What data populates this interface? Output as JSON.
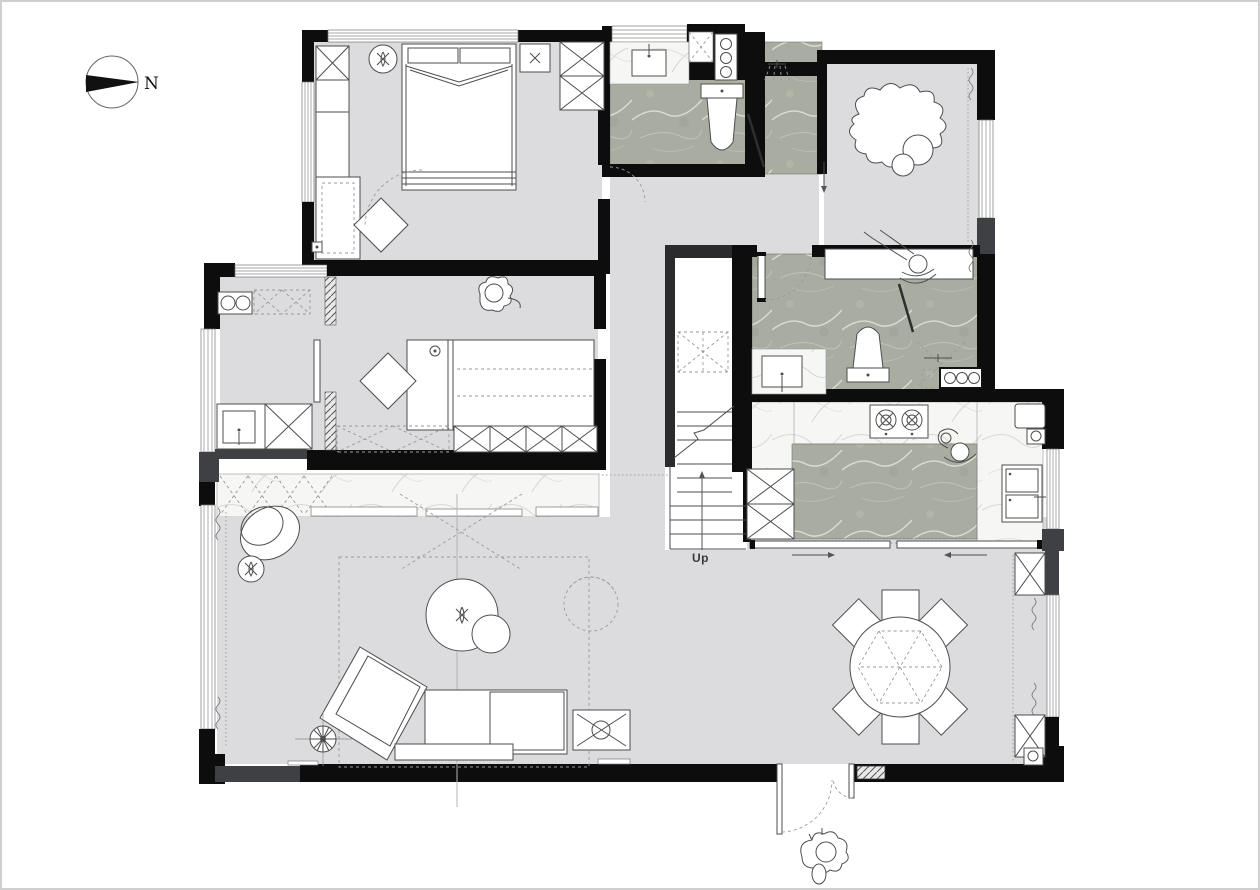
{
  "page": {
    "background": "#ffffff",
    "frame_color": "#cfcfcf",
    "type": "residential-floor-plan"
  },
  "labels": {
    "compass_north": "N",
    "stairs_up": "Up"
  },
  "colors": {
    "wall": "#0d0d0d",
    "wall_secondary": "#3e4043",
    "floor": "#dcdcde",
    "stone_floor": "#a9ada1",
    "marble_counter": "#f5f5f4",
    "outline": "#4d4d4d",
    "dashed": "#9a9a9a"
  },
  "rooms": [
    {
      "name": "master-bedroom",
      "furniture": [
        "double-bed",
        "wardrobe",
        "bookshelf-desk",
        "bedside-lamp",
        "nightstand",
        "ottoman"
      ]
    },
    {
      "name": "master-bathroom",
      "furniture": [
        "vanity-sink",
        "toilet",
        "shower-head",
        "washer-column"
      ]
    },
    {
      "name": "study",
      "furniture": [
        "desk",
        "person-working",
        "bean-bag",
        "cushions"
      ]
    },
    {
      "name": "second-bathroom",
      "furniture": [
        "vanity-sink",
        "toilet",
        "shower",
        "knob-cabinet"
      ]
    },
    {
      "name": "kitchen",
      "furniture": [
        "island",
        "cooktop-2-burner",
        "sink",
        "refrigerator",
        "person-cooking",
        "sliding-door"
      ]
    },
    {
      "name": "second-bedroom",
      "furniture": [
        "bed",
        "wardrobe",
        "ottoman",
        "cat",
        "bedside-lamp"
      ]
    },
    {
      "name": "kitchenette",
      "furniture": [
        "cooktop-2-burner",
        "sink",
        "cabinet"
      ]
    },
    {
      "name": "living-room",
      "furniture": [
        "chaise-sofa",
        "coffee-table",
        "egg-chair",
        "plant",
        "floor-lamp",
        "side-table",
        "rug",
        "swivel-chair"
      ]
    },
    {
      "name": "dining-room",
      "furniture": [
        "round-table",
        "dining-chairs"
      ],
      "dining_chair_count": 6
    },
    {
      "name": "staircase",
      "furniture": [
        "stairs",
        "up-arrow"
      ]
    },
    {
      "name": "entry",
      "furniture": [
        "double-entry-door",
        "dog"
      ]
    }
  ]
}
